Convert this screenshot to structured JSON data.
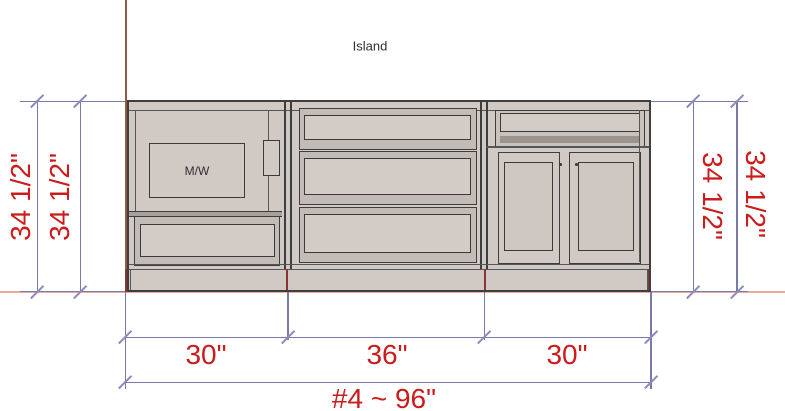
{
  "room": {
    "label": "Island"
  },
  "appliance": {
    "label": "M/W"
  },
  "dims": {
    "left": [
      "34 1/2\"",
      "34 1/2\""
    ],
    "right": [
      "34 1/2\"",
      "34 1/2\""
    ],
    "widths": [
      "30\"",
      "36\"",
      "30\""
    ],
    "overall": "#4 ~ 96\""
  },
  "cabinets": [
    {
      "id": "microwave-base-cabinet",
      "width": "30\""
    },
    {
      "id": "three-drawer-base-cabinet",
      "width": "36\""
    },
    {
      "id": "two-door-base-cabinet",
      "width": "30\""
    }
  ],
  "colors": {
    "dimension_line": "#7a7aa8",
    "dimension_text": "#cc1b1b",
    "wall_line": "#8e5b44",
    "floor_line": "#edab99",
    "cabinet_fill": "#d1cac4",
    "cabinet_outline": "#3e3e3e"
  }
}
